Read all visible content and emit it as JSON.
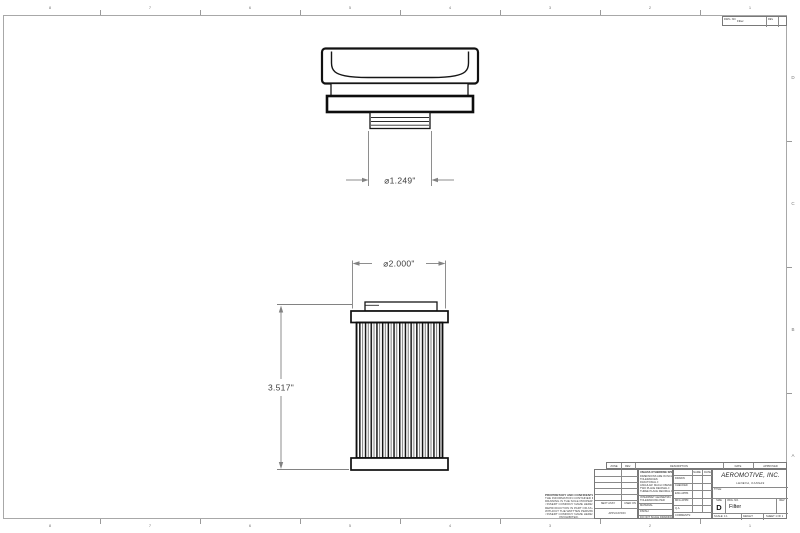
{
  "colors": {
    "outline": "#111111",
    "dimension": "#808080",
    "border": "#a8a8a8"
  },
  "views": {
    "cap": {
      "dim_diameter": "⌀1.249\""
    },
    "filter": {
      "dim_diameter": "⌀2.000\"",
      "dim_height": "3.517\""
    }
  },
  "zones": {
    "top": [
      "8",
      "7",
      "6",
      "5",
      "4",
      "3",
      "2",
      "1"
    ],
    "bottom": [
      "8",
      "7",
      "6",
      "5",
      "4",
      "3",
      "2",
      "1"
    ],
    "right": [
      "D",
      "C",
      "B",
      "A"
    ]
  },
  "corner_block": {
    "dwg_label": "DWG. NO.",
    "dwg_value": "Filter",
    "rev_label": "REV"
  },
  "rev_table": {
    "zone": "ZONE",
    "rev": "REV.",
    "description": "DESCRIPTION",
    "date": "DATE",
    "approved": "APPROVED"
  },
  "title_block": {
    "proprietary": {
      "title": "PROPRIETARY AND CONFIDENTIAL",
      "lines": [
        "THE INFORMATION CONTAINED IN THIS",
        "DRAWING IS THE SOLE PROPERTY OF",
        "<INSERT COMPANY NAME HERE>.  ANY",
        "REPRODUCTION IN PART OR AS A WHOLE",
        "WITHOUT THE WRITTEN PERMISSION OF",
        "<INSERT COMPANY NAME HERE> IS",
        "PROHIBITED."
      ]
    },
    "application": {
      "next_assy": "NEXT ASSY",
      "used_on": "USED ON",
      "label": "APPLICATION"
    },
    "tolerances": {
      "header": "UNLESS OTHERWISE SPECIFIED:",
      "lines": [
        "DIMENSIONS ARE IN INCHES",
        "TOLERANCES:",
        "FRACTIONAL ±",
        "ANGULAR: MACH ±  BEND ±",
        "TWO PLACE DECIMAL    ±",
        "THREE PLACE DECIMAL  ±"
      ],
      "interpret_1": "INTERPRET GEOMETRIC",
      "interpret_2": "TOLERANCING PER:",
      "material": "MATERIAL",
      "finish": "FINISH",
      "do_not_scale": "DO NOT SCALE DRAWING"
    },
    "signoff": {
      "header_name": "NAME",
      "header_date": "DATE",
      "rows": [
        "DRAWN",
        "CHECKED",
        "ENG APPR.",
        "MFG APPR.",
        "Q.A.",
        "COMMENTS:"
      ]
    },
    "company": {
      "name": "AEROMOTIVE, INC.",
      "tagline": "LENEXA, KANSAS"
    },
    "title_label": "TITLE:",
    "size_label": "SIZE",
    "size_value": "D",
    "dwg_label": "DWG. NO.",
    "dwg_value": "Filter",
    "rev_label": "REV",
    "scale": "SCALE: 1:1",
    "weight": "WEIGHT:",
    "sheet": "SHEET 1 OF 1"
  }
}
